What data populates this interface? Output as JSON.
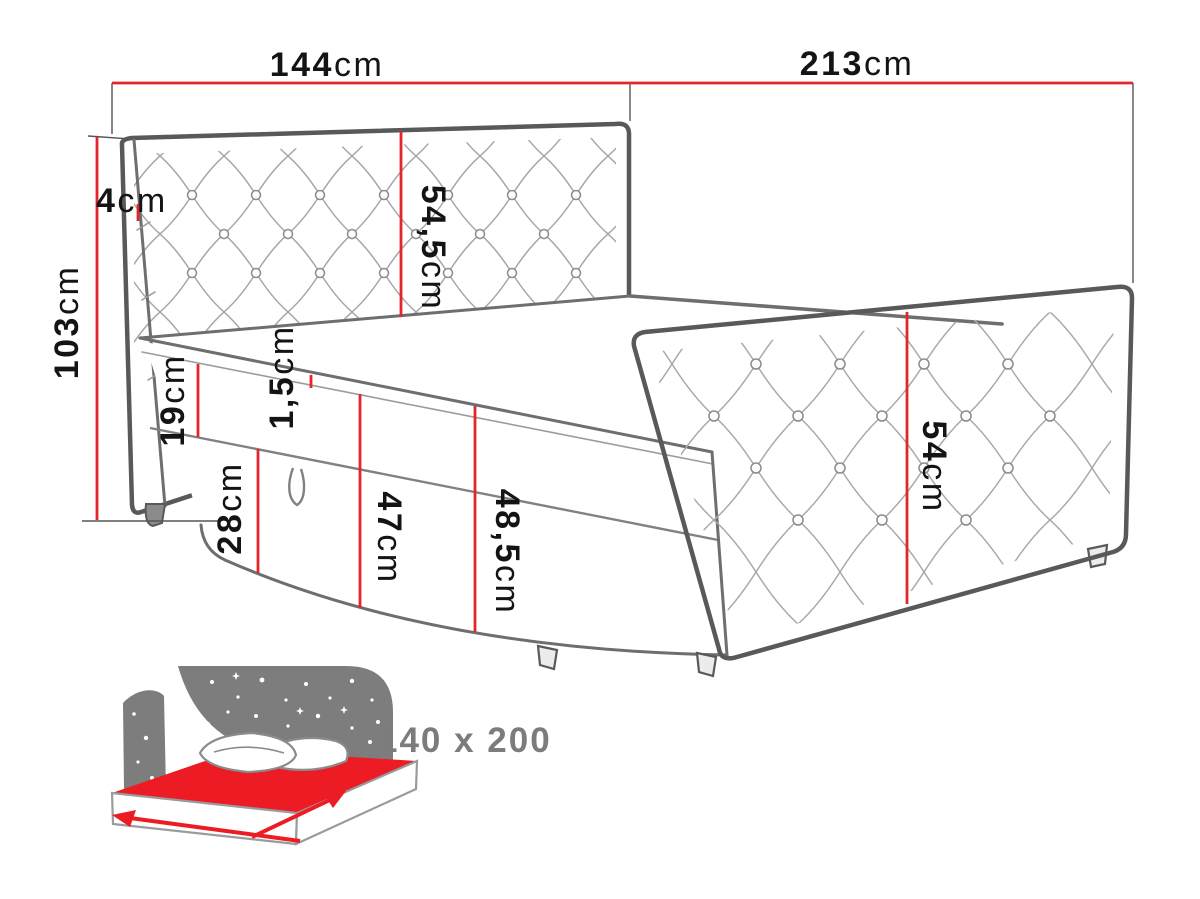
{
  "diagram_title": "bed-dimensions-diagram",
  "dims": {
    "w144": {
      "num": "144",
      "unit": "cm",
      "label": "144cm"
    },
    "w213": {
      "num": "213",
      "unit": "cm",
      "label": "213cm"
    },
    "t4": {
      "num": "4",
      "unit": "cm",
      "label": "4cm"
    },
    "h103": {
      "num": "103",
      "unit": "cm",
      "label": "103cm"
    },
    "h54_5": {
      "num": "54,5",
      "unit": "cm",
      "label": "54,5cm"
    },
    "h19": {
      "num": "19",
      "unit": "cm",
      "label": "19cm"
    },
    "h1_5": {
      "num": "1,5",
      "unit": "cm",
      "label": "1,5cm"
    },
    "h28": {
      "num": "28",
      "unit": "cm",
      "label": "28cm"
    },
    "h47": {
      "num": "47",
      "unit": "cm",
      "label": "47cm"
    },
    "h48_5": {
      "num": "48,5",
      "unit": "cm",
      "label": "48,5cm"
    },
    "h54": {
      "num": "54",
      "unit": "cm",
      "label": "54cm"
    }
  },
  "badge": {
    "size_label": "140 x 200"
  },
  "colors": {
    "dimension_red": "#e2262b",
    "icon_red": "#ed1c24",
    "icon_gray": "#7d7d7d",
    "line_dark": "#58595b",
    "badge_text": "#7c7c7c",
    "background": "#ffffff"
  }
}
